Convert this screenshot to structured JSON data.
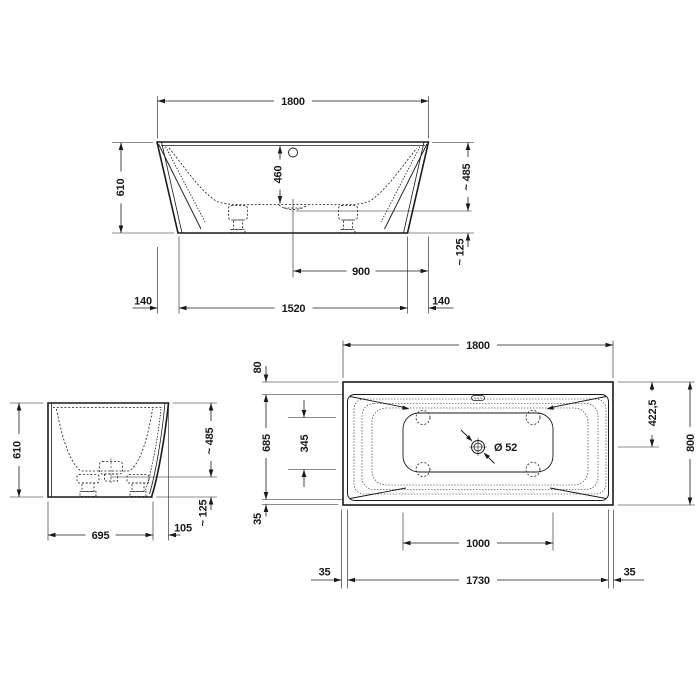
{
  "colors": {
    "background": "#ffffff",
    "line": "#1a1a1a"
  },
  "front_view": {
    "width_top": "1800",
    "height": "610",
    "inner_depth": "460",
    "rim_to_outlet": "~ 485",
    "outlet_to_floor": "~ 125",
    "center_to_right": "900",
    "width_bottom": "1520",
    "offset_left": "140",
    "offset_right": "140"
  },
  "side_view": {
    "height": "610",
    "rim_to_outlet": "~ 485",
    "outlet_to_floor": "~ 125",
    "base_depth": "695",
    "overhang": "105"
  },
  "plan_view": {
    "width_top": "1800",
    "rim_back": "80",
    "basin_width": "685",
    "feet_spacing": "345",
    "rim_front": "35",
    "outlet_from_back": "422,5",
    "depth": "800",
    "floor_length": "1000",
    "length_inner": "1730",
    "rim_left": "35",
    "rim_right": "35",
    "drain_diameter": "Ø 52"
  }
}
